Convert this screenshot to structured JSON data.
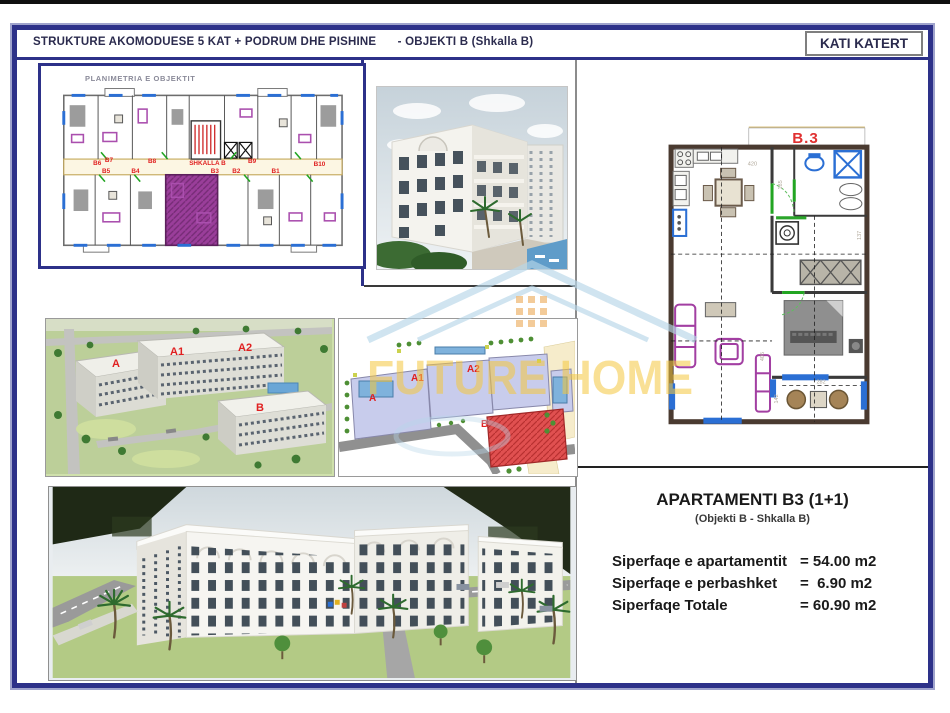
{
  "header": {
    "title_main": "STRUKTURE AKOMODUESE 5 KAT + PODRUM DHE PISHINE",
    "title_suffix": "- OBJEKTI B (Shkalla B)",
    "floor_badge": "KATI KATERT"
  },
  "overview_plan": {
    "caption": "PLANIMETRIA E OBJEKTIT",
    "stair_label": "SHKALLA B",
    "labels": [
      "B6",
      "B7",
      "B5",
      "B4",
      "B8",
      "B3",
      "B9",
      "B2",
      "B1",
      "B10"
    ]
  },
  "unit_plan": {
    "label": "B.3",
    "dims": [
      "420",
      "185",
      "137",
      "405",
      "282",
      "142"
    ]
  },
  "aerial_view": {
    "labels": [
      "A",
      "A1",
      "A2",
      "B"
    ]
  },
  "site_plan": {
    "labels": [
      "A",
      "A1",
      "A2",
      "B"
    ]
  },
  "watermark": {
    "text": "FUTURE HOME"
  },
  "info_panel": {
    "title": "APARTAMENTI B3 (1+1)",
    "subtitle": "(Objekti B - Shkalla B)",
    "rows": [
      {
        "label": "Siperfaqe e apartamentit",
        "value": "= 54.00 m2"
      },
      {
        "label": "Siperfaqe e perbashket",
        "value": "=  6.90 m2"
      },
      {
        "label": "Siperfaqe Totale",
        "value": "= 60.90 m2"
      }
    ]
  },
  "colors": {
    "frame_navy": "#2d3189",
    "label_red": "#e02020",
    "highlight_purple": "#993d99",
    "site_highlight_red": "#e05050",
    "watermark_yellow": "#f5c83f",
    "watermark_blue": "#b7d7e9"
  }
}
